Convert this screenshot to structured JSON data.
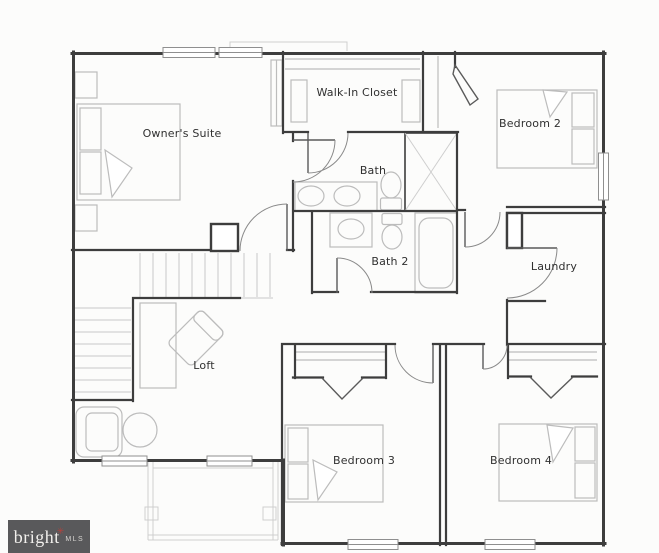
{
  "watermark": {
    "brand": "bright",
    "mls": "MLS"
  },
  "rooms": [
    {
      "id": "owners-suite",
      "label": "Owner's Suite"
    },
    {
      "id": "walk-in-closet",
      "label": "Walk-In Closet"
    },
    {
      "id": "bath",
      "label": "Bath"
    },
    {
      "id": "bedroom-2",
      "label": "Bedroom 2"
    },
    {
      "id": "bath-2",
      "label": "Bath 2"
    },
    {
      "id": "laundry",
      "label": "Laundry"
    },
    {
      "id": "loft",
      "label": "Loft"
    },
    {
      "id": "bedroom-3",
      "label": "Bedroom 3"
    },
    {
      "id": "bedroom-4",
      "label": "Bedroom 4"
    }
  ],
  "colors": {
    "wall": "#3d3d3d",
    "furniture": "#bcbcbc",
    "light_detail": "#cfcfcf",
    "background": "#fcfcfb",
    "label": "#303030",
    "watermark_bg": "#59595b",
    "watermark_text": "#f2f0ed",
    "watermark_accent": "#b5413c"
  }
}
